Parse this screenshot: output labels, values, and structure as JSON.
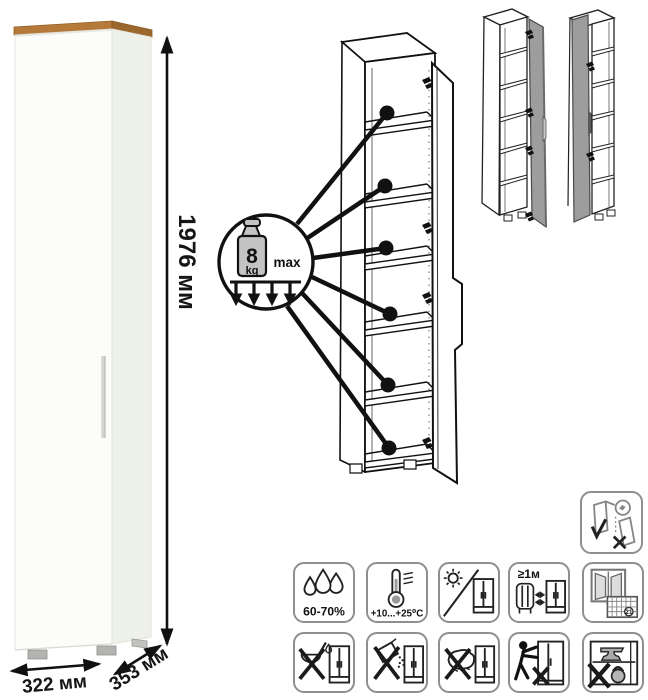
{
  "dimensions": {
    "height": "1976 мм",
    "width": "322 мм",
    "depth": "353 мм"
  },
  "shelf_load": {
    "value": "8",
    "unit": "kg",
    "qualifier": "max"
  },
  "care": {
    "humidity": "60-70%",
    "temperature": "+10...+25⁰C",
    "heat_distance": "≥1м",
    "calendar_day": "21"
  },
  "icon_names": [
    "wall-anchoring-required",
    "humidity-range",
    "temperature-range",
    "no-direct-sunlight",
    "min-1m-from-heat-source",
    "ventilate-room",
    "no-sharp-objects",
    "no-abrasive-powders",
    "no-harsh-wet-cleaning",
    "no-dragging",
    "no-overloading"
  ],
  "colors": {
    "wood_top": "#b5793a",
    "cabinet_front": "#fcfcfa",
    "cabinet_side": "#eef0ea",
    "variant_door_gray": "#9d9d9d",
    "line_art": "#111111",
    "icon_border": "#8f8f8f"
  }
}
